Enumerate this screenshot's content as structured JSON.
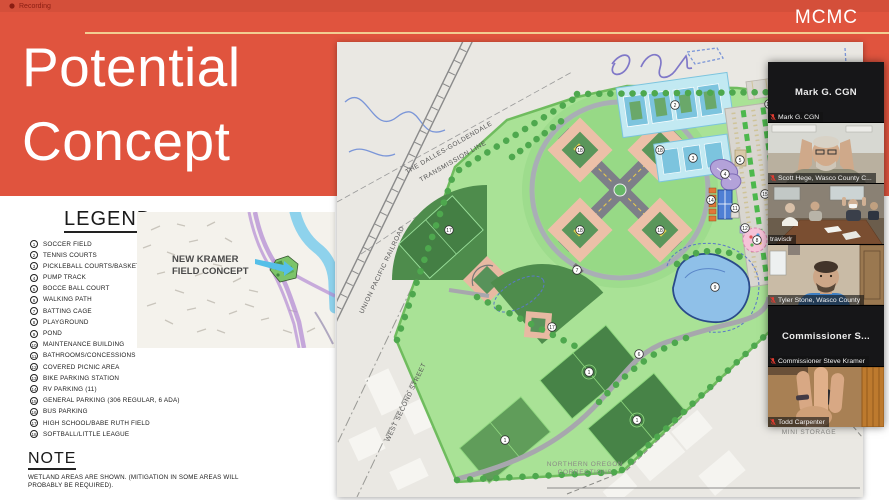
{
  "meeting": {
    "recording_label": "Recording",
    "participants": [
      {
        "center_name": "Mark G. CGN",
        "label": "Mark G. CGN",
        "muted": true
      },
      {
        "center_name": "",
        "label": "Scott Hege, Wasco County C...",
        "muted": true
      },
      {
        "center_name": "",
        "label": "travisdr",
        "muted": false
      },
      {
        "center_name": "",
        "label": "Tyler Stone, Wasco County",
        "muted": true
      },
      {
        "center_name": "Commissioner  S...",
        "label": "Commissioner Steve Kramer",
        "muted": true
      },
      {
        "center_name": "",
        "label": "Todd Carpenter",
        "muted": true
      }
    ]
  },
  "slide": {
    "brand": "MCMC",
    "title_line1": "Potential",
    "title_line2": "Concept",
    "accent_color": "#e0543e",
    "underline_color": "#f2cd92"
  },
  "legend": {
    "title": "LEGEND",
    "items": [
      {
        "num": "1",
        "label": "SOCCER FIELD"
      },
      {
        "num": "2",
        "label": "TENNIS COURTS"
      },
      {
        "num": "3",
        "label": "PICKLEBALL COURTS/BASKETBALL"
      },
      {
        "num": "4",
        "label": "PUMP TRACK"
      },
      {
        "num": "5",
        "label": "BOCCE BALL COURT"
      },
      {
        "num": "6",
        "label": "WALKING PATH"
      },
      {
        "num": "7",
        "label": "BATTING CAGE"
      },
      {
        "num": "8",
        "label": "PLAYGROUND"
      },
      {
        "num": "9",
        "label": "POND"
      },
      {
        "num": "10",
        "label": "MAINTENANCE BUILDING"
      },
      {
        "num": "11",
        "label": "BATHROOMS/CONCESSIONS"
      },
      {
        "num": "12",
        "label": "COVERED PICNIC AREA"
      },
      {
        "num": "13",
        "label": "BIKE PARKING STATION"
      },
      {
        "num": "14",
        "label": "RV PARKING (11)"
      },
      {
        "num": "15",
        "label": "GENERAL PARKING (306 REGULAR, 6 ADA)"
      },
      {
        "num": "16",
        "label": "BUS PARKING"
      },
      {
        "num": "17",
        "label": "HIGH SCHOOL/BABE RUTH FIELD"
      },
      {
        "num": "18",
        "label": "SOFTBALL/LITTLE LEAGUE"
      }
    ]
  },
  "note": {
    "title": "NOTE",
    "text": "WETLAND AREAS ARE SHOWN. (MITIGATION IN SOME AREAS WILL PROBABLY BE REQUIRED)."
  },
  "locator": {
    "label_line1": "NEW KRAMER",
    "label_line2": "FIELD CONCEPT"
  },
  "map": {
    "labels": {
      "transmission_1": "THE DALLES-GOLDENDALE",
      "transmission_2": "TRANSMISSION LINE",
      "railroad": "UNION PACIFIC RAILROAD",
      "street": "WEST SECOND STREET",
      "corrections_1": "NORTHERN OREGON",
      "corrections_2": "CORRECTIONS",
      "storage_1": "OREGON TRAIL",
      "storage_2": "MINI STORAGE"
    },
    "markers": [
      {
        "n": "17"
      },
      {
        "n": "18"
      },
      {
        "n": "18"
      },
      {
        "n": "18"
      },
      {
        "n": "18"
      },
      {
        "n": "1"
      },
      {
        "n": "1"
      },
      {
        "n": "1"
      },
      {
        "n": "2"
      },
      {
        "n": "3"
      },
      {
        "n": "4"
      },
      {
        "n": "8"
      },
      {
        "n": "9"
      },
      {
        "n": "15"
      },
      {
        "n": "6"
      },
      {
        "n": "16"
      },
      {
        "n": "14"
      },
      {
        "n": "17"
      },
      {
        "n": "7"
      },
      {
        "n": "11"
      },
      {
        "n": "12"
      },
      {
        "n": "10"
      },
      {
        "n": "5"
      }
    ]
  }
}
